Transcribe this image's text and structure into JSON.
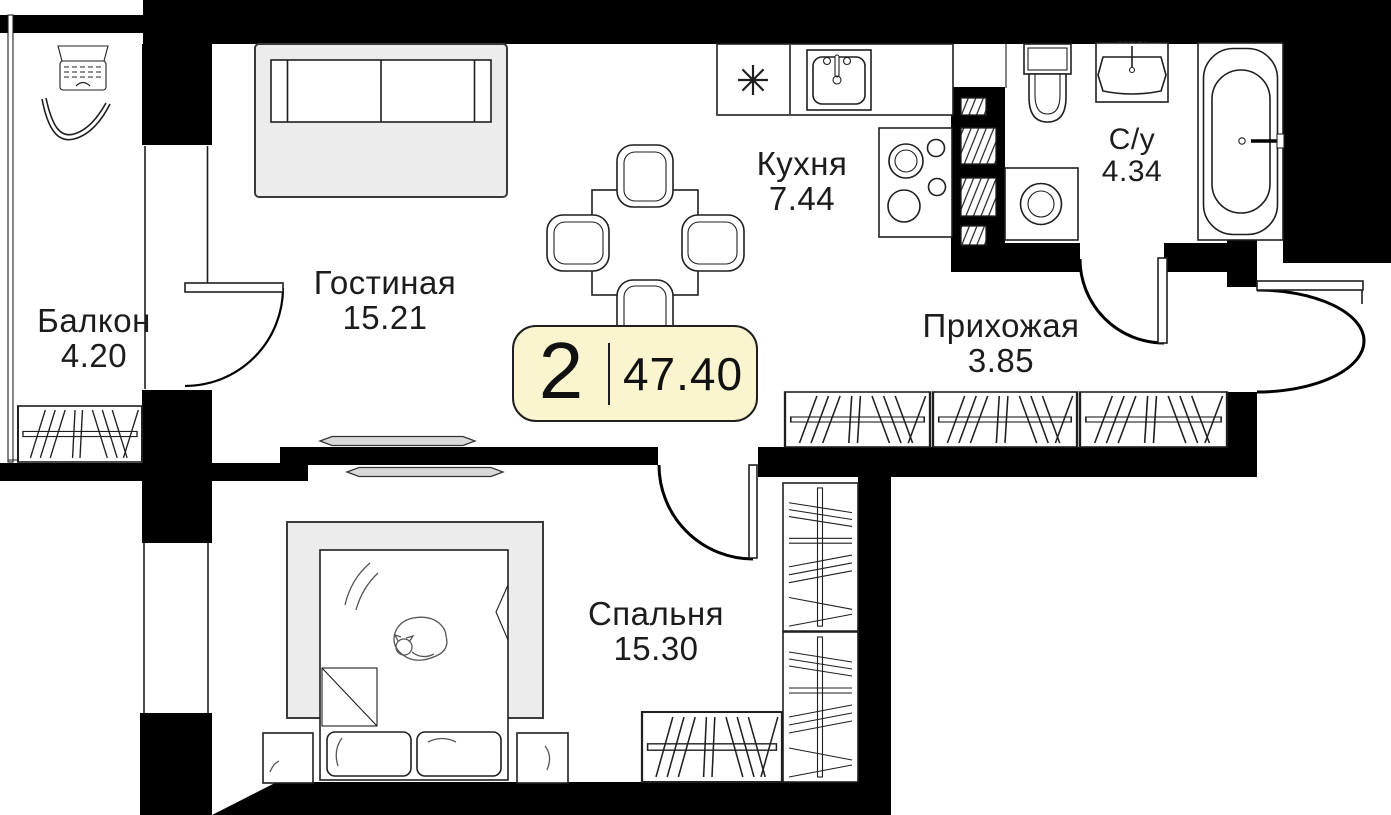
{
  "floor_plan": {
    "badge": {
      "rooms_count": "2",
      "total_area": "47.40"
    },
    "rooms": [
      {
        "name": "Балкон",
        "area": "4.20"
      },
      {
        "name": "Гостиная",
        "area": "15.21"
      },
      {
        "name": "Кухня",
        "area": "7.44"
      },
      {
        "name": "С/у",
        "area": "4.34"
      },
      {
        "name": "Прихожая",
        "area": "3.85"
      },
      {
        "name": "Спальня",
        "area": "15.30"
      }
    ],
    "colors": {
      "walls": "#000000",
      "badge_background": "#FAF4CF",
      "badge_border": "#1F1F1F",
      "furniture_fill": "#FFFFFF",
      "upholstery_gray": "#ECECEC",
      "tv_gray": "#D9D9D9"
    }
  }
}
